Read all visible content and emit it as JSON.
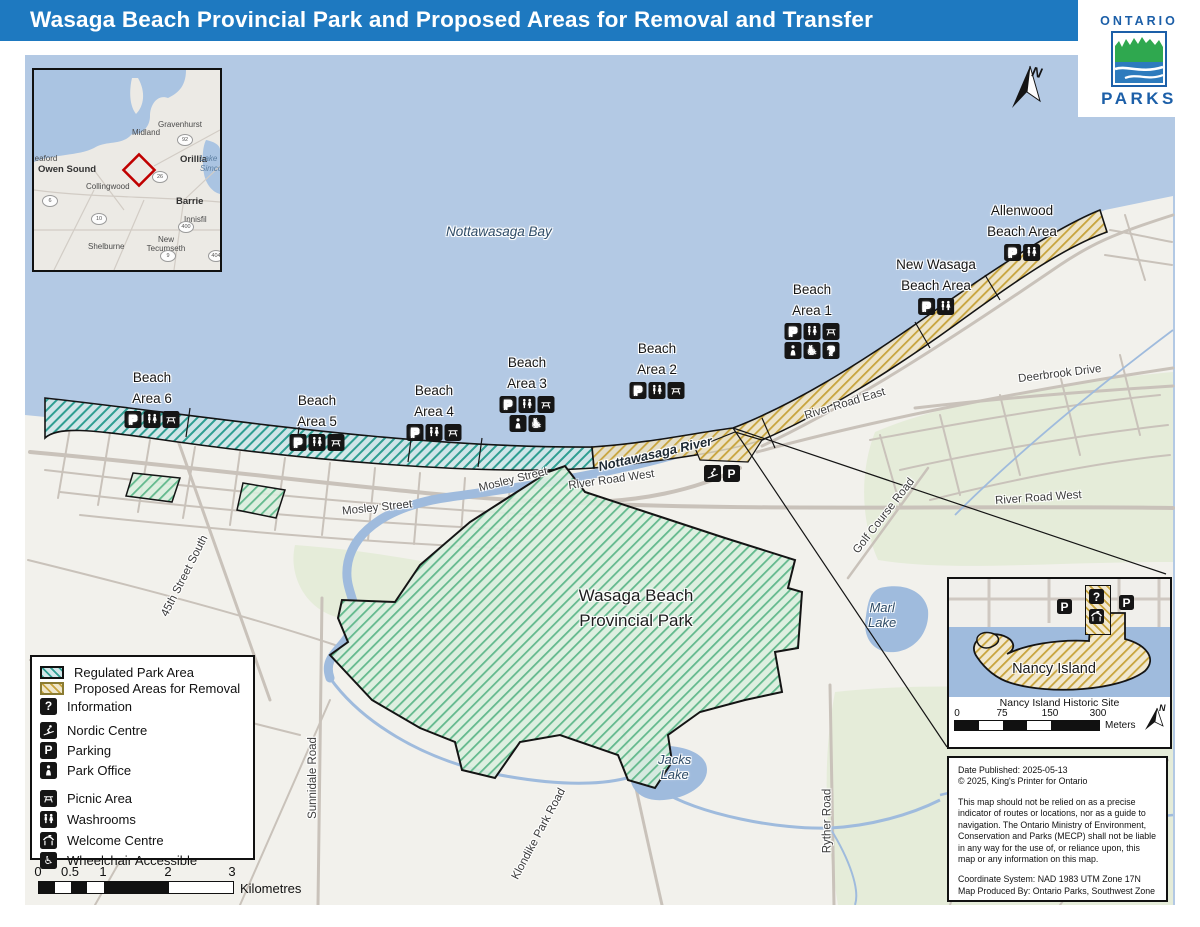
{
  "header": {
    "title": "Wasaga Beach Provincial Park and Proposed Areas for Removal and Transfer"
  },
  "logo": {
    "top": "ONTARIO",
    "bottom": "PARKS"
  },
  "north_arrow_label": "N",
  "bay_label": "Nottawasaga Bay",
  "river_label": "Nottawasaga River",
  "park_label": {
    "line1": "Wasaga Beach",
    "line2": "Provincial Park"
  },
  "lakes": {
    "marl1": "Marl",
    "marl2": "Lake",
    "jacks1": "Jacks",
    "jacks2": "Lake"
  },
  "roads": {
    "mosley": "Mosley Street",
    "street45": "45th Street South",
    "sunnidale": "Sunnidale Road",
    "klondike": "Klondike Park Road",
    "ryther": "Ryther Road",
    "river_road_west": "River Road West",
    "river_road_east": "River Road East",
    "deerbrook": "Deerbrook Drive",
    "golf_course": "Golf Course Road"
  },
  "beach_areas": [
    {
      "line1": "Beach",
      "line2": "Area 6",
      "icons": [
        "parking",
        "washrooms",
        "picnic-area"
      ]
    },
    {
      "line1": "Beach",
      "line2": "Area 5",
      "icons": [
        "parking",
        "washrooms",
        "picnic-area"
      ]
    },
    {
      "line1": "Beach",
      "line2": "Area 4",
      "icons": [
        "parking",
        "washrooms",
        "picnic-area"
      ]
    },
    {
      "line1": "Beach",
      "line2": "Area 3",
      "icons": [
        "parking",
        "washrooms",
        "picnic-area"
      ],
      "icons2": [
        "park-office",
        "wheelchair"
      ]
    },
    {
      "line1": "Beach",
      "line2": "Area 2",
      "icons": [
        "parking",
        "washrooms",
        "picnic-area"
      ]
    },
    {
      "line1": "Beach",
      "line2": "Area 1",
      "icons": [
        "parking",
        "washrooms",
        "picnic-area"
      ],
      "icons2": [
        "park-office",
        "wheelchair",
        "information"
      ]
    },
    {
      "line1": "New Wasaga",
      "line2": "Beach Area",
      "icons": [
        "parking",
        "washrooms"
      ]
    },
    {
      "line1": "Allenwood",
      "line2": "Beach Area",
      "icons": [
        "parking",
        "washrooms"
      ]
    }
  ],
  "map_icons": {
    "river_cluster": [
      "nordic-centre",
      "parking"
    ]
  },
  "legend": {
    "items": [
      {
        "icon": "swatch-regulated",
        "label": "Regulated Park Area"
      },
      {
        "icon": "swatch-proposed",
        "label": "Proposed Areas for Removal"
      },
      {
        "icon": "information",
        "label": "Information"
      },
      {
        "icon": "nordic-centre",
        "label": "Nordic Centre"
      },
      {
        "icon": "parking",
        "label": "Parking"
      },
      {
        "icon": "park-office",
        "label": "Park Office"
      },
      {
        "icon": "picnic-area",
        "label": "Picnic Area"
      },
      {
        "icon": "washrooms",
        "label": "Washrooms"
      },
      {
        "icon": "welcome-centre",
        "label": "Welcome Centre"
      },
      {
        "icon": "wheelchair",
        "label": "Wheelchair Accessible"
      }
    ]
  },
  "scale_bar": {
    "ticks": [
      "0",
      "0.5",
      "1",
      "2",
      "3"
    ],
    "unit": "Kilometres"
  },
  "overview": {
    "places": {
      "meaford": "Meaford",
      "owen_sound": "Owen Sound",
      "collingwood": "Collingwood",
      "midland": "Midland",
      "gravenhurst": "Gravenhurst",
      "orillia": "Orillia",
      "barrie": "Barrie",
      "innisfil": "Innisfil",
      "shelburne": "Shelburne",
      "new_tecumseth": "New Tecumseth",
      "orangeville": "Orangeville",
      "lake_simcoe": "Lake Simcoe"
    },
    "shields": [
      "92",
      "26",
      "6",
      "10",
      "400",
      "9",
      "404"
    ]
  },
  "nancy_inset": {
    "island_label": "Nancy Island",
    "site_label": "Nancy Island Historic Site",
    "ticks": [
      "0",
      "75",
      "150",
      "300"
    ],
    "unit": "Meters",
    "icons": [
      "parking",
      "information",
      "welcome-centre",
      "parking"
    ],
    "north_label": "N"
  },
  "disclaimer": {
    "line1": "Date Published: 2025-05-13",
    "line2": "© 2025, King's Printer for Ontario",
    "para": "This map should not be relied on as a precise indicator of routes or locations, nor as a guide to navigation. The Ontario Ministry of Environment, Conservation and Parks (MECP) shall not be liable in any way for the use of, or reliance upon, this map or any information on this map.",
    "line3": "Coordinate System: NAD 1983 UTM Zone 17N",
    "line4": "Map Produced By: Ontario Parks, Southwest Zone"
  },
  "colors": {
    "header_blue": "#1e79c0",
    "regulated_teal": "#2f9e92",
    "proposed_gold": "#c8a43c",
    "park_green": "#63b98d"
  }
}
